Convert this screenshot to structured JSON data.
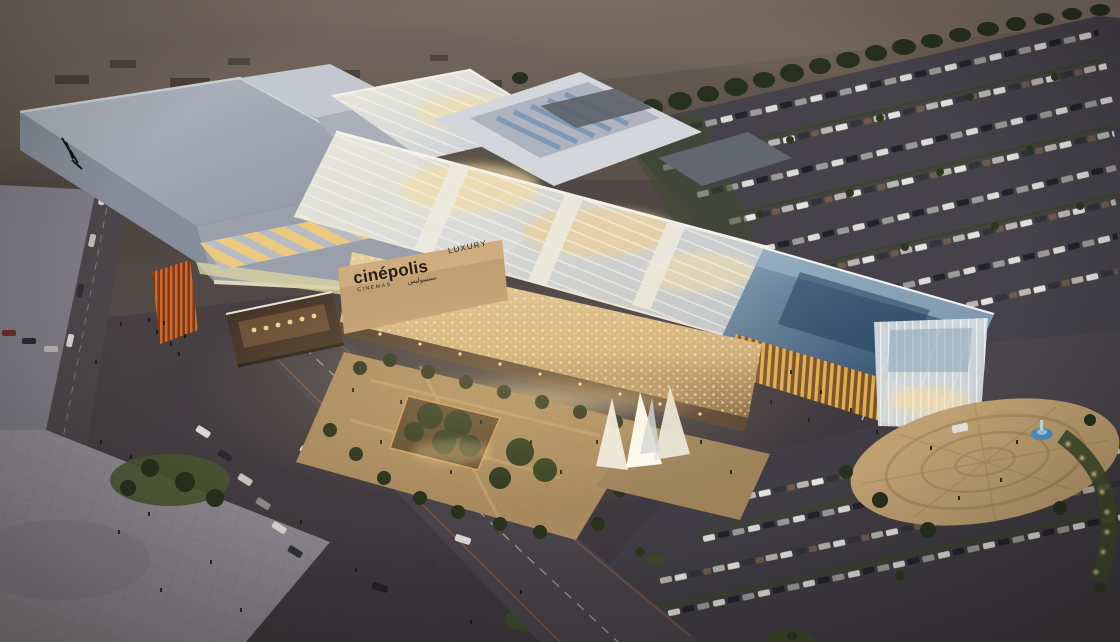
{
  "scene": {
    "type": "architectural-rendering",
    "description": "Aerial dusk rendering of a luxury shopping mall: gray flat big-box roofs, a glowing glass galleria spine, blue cantilevered entrance canopy, Cinépolis Luxury cinema signage on a cream stone facade, palm-tree courtyard, circular drop-off plaza with small fountain, and large parking lots full of cars against a desert horizon",
    "time_of_day": "dusk"
  },
  "signage": {
    "brand": "cinépolis",
    "brand_sub": "CINEMAS",
    "brand_arabic": "سينيبوليس",
    "tier": "LUXURY"
  },
  "palette": {
    "desert_top": "#7b6d63",
    "desert_dark": "#51473f",
    "foliage_dark": "#2b3420",
    "grass": "#3e4a2b",
    "asphalt": "#434046",
    "plaza_gray": "#8f8b92",
    "roof_gray": "#a9afbb",
    "parapet_cream": "#ddd6bc",
    "glass_pale": "#e3e4df",
    "glass_warm_glow": "#f6dda4",
    "canopy_blue_light": "#7c97ae",
    "canopy_blue_dark": "#33506e",
    "facade_gold": "#d6ba8c",
    "sign_wall_tan": "#bf9d72",
    "sign_text": "#241e17",
    "orange_feature": "#bf5b28",
    "courtyard_tan": "#ac8c5e",
    "fountain_blue": "#4f95c5",
    "car_white": "#dcdbd6",
    "warm_light": "#ffd998"
  }
}
